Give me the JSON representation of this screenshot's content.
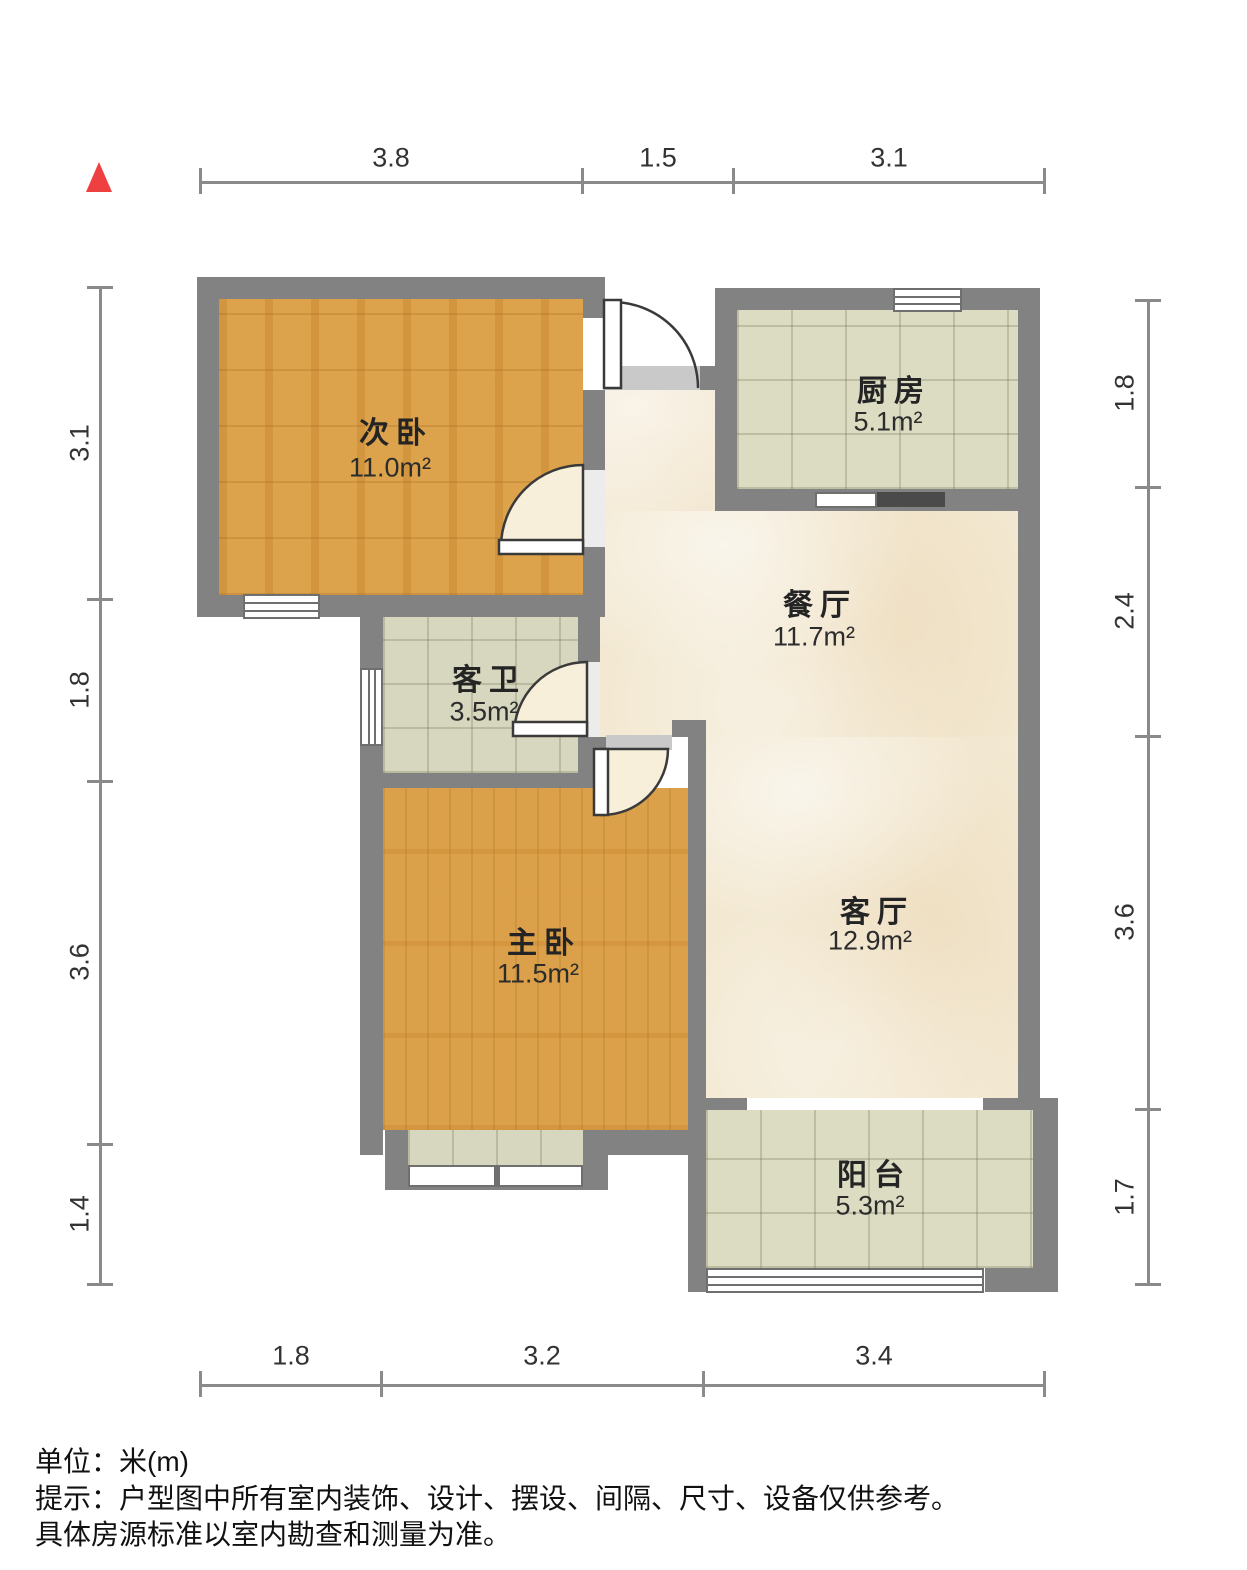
{
  "north_arrow": {
    "icon": "north-arrow",
    "color": "#ee4040"
  },
  "rooms": [
    {
      "name": "次卧",
      "area": "11.0m²"
    },
    {
      "name": "厨房",
      "area": "5.1m²"
    },
    {
      "name": "餐厅",
      "area": "11.7m²"
    },
    {
      "name": "客卫",
      "area": "3.5m²"
    },
    {
      "name": "主卧",
      "area": "11.5m²"
    },
    {
      "name": "客厅",
      "area": "12.9m²"
    },
    {
      "name": "阳台",
      "area": "5.3m²"
    }
  ],
  "dimensions": {
    "top": [
      "3.8",
      "1.5",
      "3.1"
    ],
    "bottom": [
      "1.8",
      "3.2",
      "3.4"
    ],
    "left": [
      "3.1",
      "1.8",
      "3.6",
      "1.4"
    ],
    "right": [
      "1.8",
      "2.4",
      "3.6",
      "1.7"
    ]
  },
  "footer": {
    "unit": "单位：米(m)",
    "tip_line1": "提示：户型图中所有室内装饰、设计、摆设、间隔、尺寸、设备仅供参考。",
    "tip_line2": "具体房源标准以室内勘查和测量为准。"
  },
  "colors": {
    "wall": "#828282",
    "wood_floor": "#d89b42",
    "tile_floor": "#dcdcc3",
    "marble_floor": "#f3e9d3",
    "door_swing": "#f7efda",
    "north_arrow": "#ee4040",
    "dimension_line": "#8a8a8a"
  }
}
